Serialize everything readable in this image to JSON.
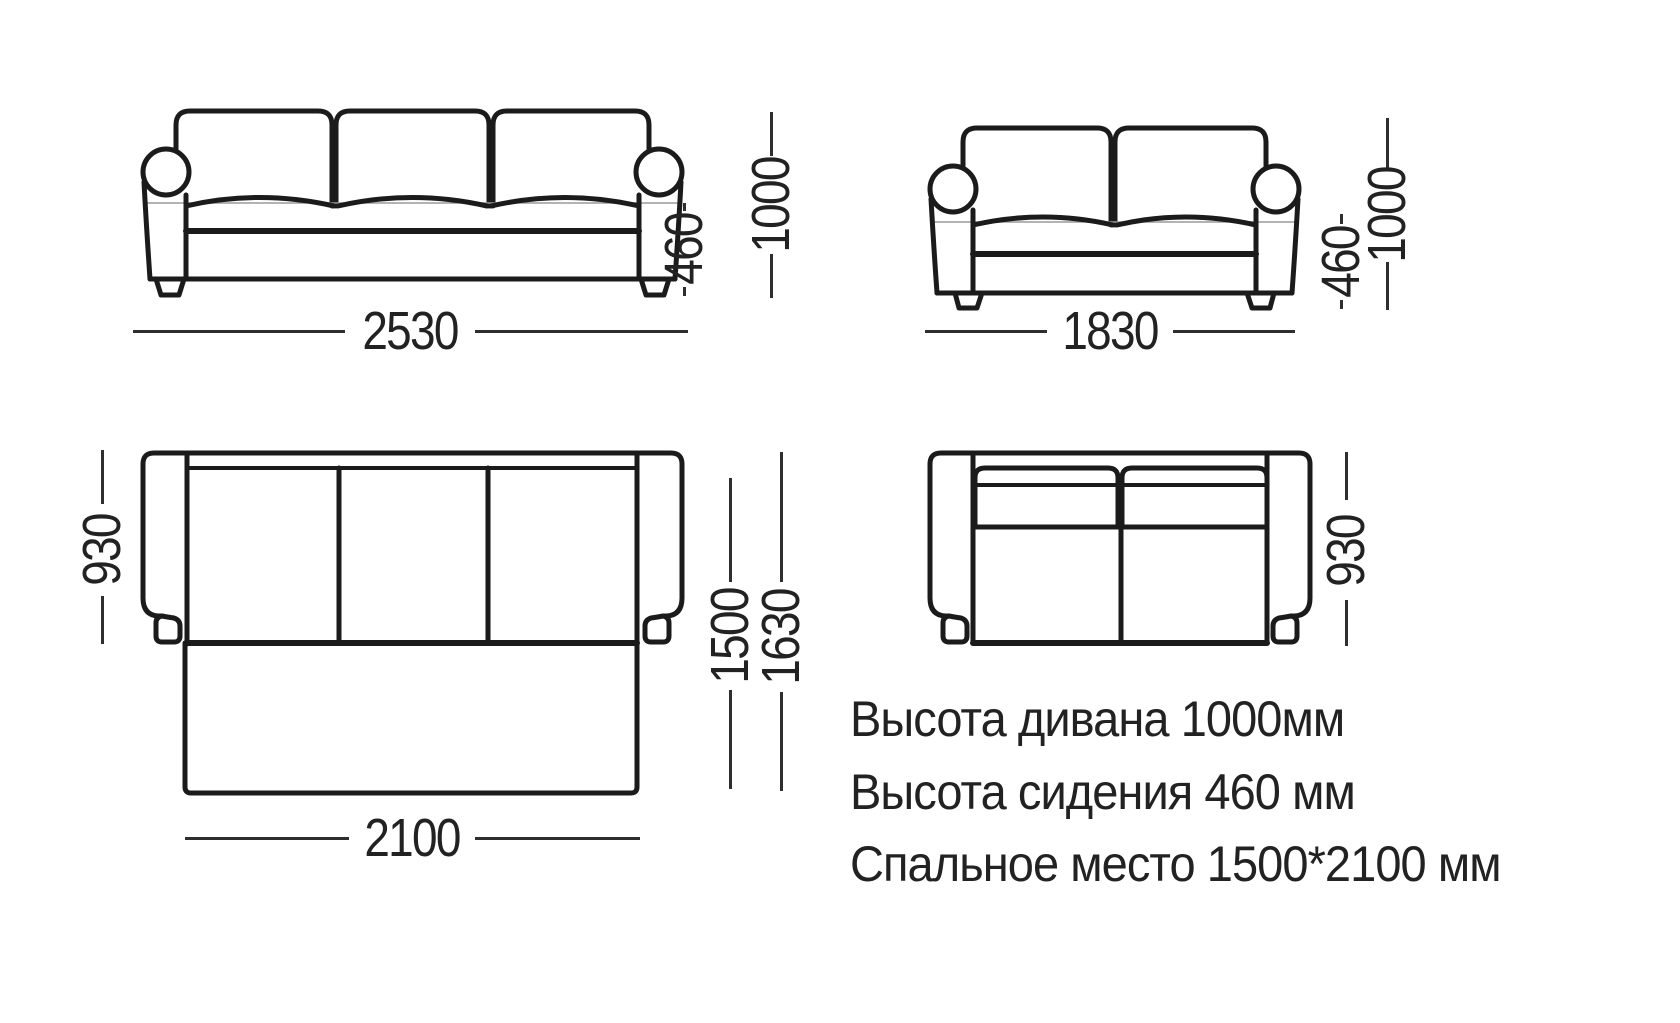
{
  "title": "Sofa dimensions technical diagram",
  "views": {
    "sofa3_front": {
      "label": "three-seat sofa front view",
      "width": "2530",
      "seat_height": "460",
      "total_height": "1000"
    },
    "sofa2_front": {
      "label": "two-seat sofa front view",
      "width": "1830",
      "seat_height": "460",
      "total_height": "1000"
    },
    "sofa3_top_bed": {
      "label": "three-seat sofa-bed top view unfolded",
      "depth": "930",
      "bed_depth": "1500",
      "bed_total_depth": "1630",
      "bed_width": "2100"
    },
    "sofa2_top": {
      "label": "two-seat sofa top view",
      "depth": "930"
    }
  },
  "notes": [
    "Высота дивана 1000мм",
    "Высота сидения 460 мм",
    "Спальное место 1500*2100 мм"
  ],
  "colors": {
    "stroke": "#1b1b1b",
    "dim_line": "#2e2e2e",
    "text": "#222222",
    "seam": "#9a9a9a",
    "background": "#ffffff"
  }
}
